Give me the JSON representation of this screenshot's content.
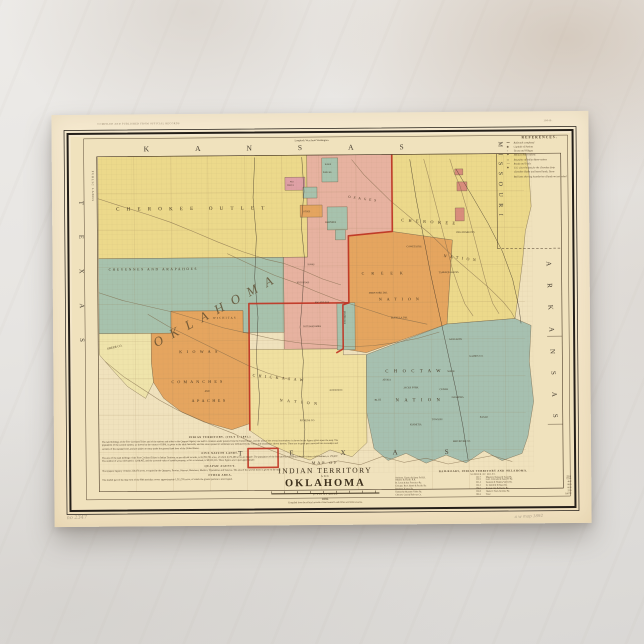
{
  "postcard": {
    "imprint_top_left": "COMPILED AND PUBLISHED FROM OFFICIAL RECORDS",
    "imprint_top_right": "18049.",
    "pencil_left": "no 2347",
    "pencil_right": "a w map 1892"
  },
  "map": {
    "palette": {
      "ivory": "#f0e2bd",
      "yellow": "#ecd98b",
      "paleYellow": "#efe4ab",
      "chickasaw": "#f0e0a0",
      "teal": "#a7c2ad",
      "choctawTeal": "#a6c0b0",
      "salmon": "#e7b2a0",
      "pink": "#dfa0a6",
      "orange": "#e5a55f",
      "red": "#c03524",
      "missouri": "#d98c7c"
    },
    "legend": {
      "title": "REFERENCES.",
      "entries": [
        {
          "s": "━━",
          "t": "Railroads completed"
        },
        {
          "s": "◉",
          "t": "Capitals of Nations"
        },
        {
          "s": "○",
          "t": "Towns and Villages"
        },
        {
          "s": "⚑",
          "t": "Military Reservations"
        },
        {
          "s": "▭",
          "t": "Boundary of Indian Reservations"
        },
        {
          "s": "╌╌",
          "t": "Roads and Trails"
        },
        {
          "s": "✚",
          "t": "U.S. Court houses for the Cherokee Strip"
        },
        {
          "s": "",
          "t": "Cherokee Outlet and leased lands, Texas"
        },
        {
          "s": "",
          "t": "Red lines showing boundaries of lands not yet ceded"
        }
      ]
    },
    "labels": [
      {
        "t": "KANSAS",
        "x": 92,
        "y": 37,
        "fs": 7.5,
        "ls": 46,
        "c": "state"
      },
      {
        "t": "MISSOURI",
        "x": 447,
        "y": 30,
        "fs": 6,
        "ls": 6.5,
        "r": 90,
        "c": "state"
      },
      {
        "t": "ARKANSAS",
        "x": 494,
        "y": 150,
        "fs": 7,
        "ls": 17,
        "r": 88,
        "c": "state"
      },
      {
        "t": "TEXAS",
        "x": 27,
        "y": 86,
        "fs": 6.5,
        "ls": 30,
        "r": 90,
        "c": "state"
      },
      {
        "t": "TEXAS",
        "x": 184,
        "y": 342,
        "fs": 7,
        "ls": 47,
        "c": "state"
      },
      {
        "t": "PUBLIC LANDS",
        "x": 40,
        "y": 56,
        "fs": 2.7,
        "ls": 1,
        "r": 90,
        "c": "small"
      },
      {
        "t": "Longitude West from Washington.",
        "x": 243,
        "y": 28,
        "fs": 2.5,
        "c": "small"
      },
      {
        "t": "CHEROKEE OUTLET",
        "x": 64,
        "y": 96,
        "fs": 5,
        "ls": 7.2
      },
      {
        "t": "CHEYENNES AND ARAPAHOES",
        "x": 56,
        "y": 156,
        "fs": 3.5,
        "ls": 1.7
      },
      {
        "t": "OKLAHOMA",
        "x": 103,
        "y": 233,
        "fs": 13,
        "ls": 9,
        "r": -28,
        "c": "big"
      },
      {
        "t": "KIOWAS",
        "x": 126,
        "y": 239,
        "fs": 4,
        "ls": 4.5
      },
      {
        "t": "COMANCHES",
        "x": 118,
        "y": 269,
        "fs": 4,
        "ls": 3.2
      },
      {
        "t": "AND",
        "x": 151,
        "y": 278,
        "fs": 2.4
      },
      {
        "t": "APACHES",
        "x": 138,
        "y": 288,
        "fs": 4,
        "ls": 2.6
      },
      {
        "t": "WICHITAS",
        "x": 160,
        "y": 205,
        "fs": 2.8,
        "ls": 1.3
      },
      {
        "t": "GREER CO.",
        "x": 54,
        "y": 235,
        "fs": 3,
        "r": -12
      },
      {
        "t": "CHICKASAW",
        "x": 199,
        "y": 263,
        "fs": 4,
        "ls": 3.4,
        "r": 6
      },
      {
        "t": "NATION",
        "x": 226,
        "y": 288,
        "fs": 4,
        "ls": 4.5,
        "r": 6
      },
      {
        "t": "CREEK",
        "x": 309,
        "y": 162,
        "fs": 4,
        "ls": 7
      },
      {
        "t": "NATION",
        "x": 326,
        "y": 188,
        "fs": 4,
        "ls": 5
      },
      {
        "t": "CHEROKEE",
        "x": 349,
        "y": 109,
        "fs": 4.2,
        "ls": 4.5,
        "r": 4
      },
      {
        "t": "NATION",
        "x": 391,
        "y": 145,
        "fs": 4,
        "ls": 3.5,
        "r": 8
      },
      {
        "t": "CHOCTAW",
        "x": 332,
        "y": 260,
        "fs": 4.5,
        "ls": 5.5
      },
      {
        "t": "NATION",
        "x": 342,
        "y": 289,
        "fs": 4.5,
        "ls": 5.5
      },
      {
        "t": "OSAGES",
        "x": 296,
        "y": 85,
        "fs": 3.4,
        "ls": 3,
        "r": 8
      },
      {
        "t": "PAWNEES",
        "x": 273,
        "y": 110,
        "fs": 2.4,
        "c": "small"
      },
      {
        "t": "NEZ",
        "x": 238,
        "y": 69,
        "fs": 1.9,
        "c": "small"
      },
      {
        "t": "PERCES",
        "x": 235,
        "y": 72.5,
        "fs": 1.9,
        "c": "small"
      },
      {
        "t": "OTOES",
        "x": 251,
        "y": 99,
        "fs": 2.2,
        "c": "small"
      },
      {
        "t": "KAWS",
        "x": 273,
        "y": 52,
        "fs": 2.2,
        "c": "small"
      },
      {
        "t": "PONCAS",
        "x": 271,
        "y": 60,
        "fs": 2.2,
        "c": "small"
      },
      {
        "t": "SEMINOLES",
        "x": 291,
        "y": 198,
        "fs": 2.4,
        "r": 90,
        "c": "small"
      },
      {
        "t": "IOWAS",
        "x": 255,
        "y": 152,
        "fs": 2.2,
        "c": "small"
      },
      {
        "t": "KICKAPOOS",
        "x": 244,
        "y": 170,
        "fs": 2.2,
        "c": "small"
      },
      {
        "t": "POTTAWATOMIES",
        "x": 250,
        "y": 214,
        "fs": 2.2,
        "c": "small"
      },
      {
        "t": "SAC AND FOX",
        "x": 262,
        "y": 190,
        "fs": 2.2,
        "c": "small"
      },
      {
        "t": "SANS BOIS",
        "x": 396,
        "y": 228,
        "fs": 2.5,
        "c": "small"
      },
      {
        "t": "GAINES CO.",
        "x": 416,
        "y": 245,
        "fs": 2.5,
        "c": "small"
      },
      {
        "t": "JACKS FORK",
        "x": 350,
        "y": 276,
        "fs": 2.5,
        "c": "small"
      },
      {
        "t": "CEDAR",
        "x": 386,
        "y": 278,
        "fs": 2.5,
        "c": "small"
      },
      {
        "t": "NASHOBA",
        "x": 398,
        "y": 286,
        "fs": 2.5,
        "c": "small"
      },
      {
        "t": "WADE",
        "x": 394,
        "y": 260,
        "fs": 2.5,
        "c": "small"
      },
      {
        "t": "TOWSON",
        "x": 378,
        "y": 308,
        "fs": 2.5,
        "c": "small"
      },
      {
        "t": "EAGLE",
        "x": 426,
        "y": 306,
        "fs": 2.5,
        "c": "small"
      },
      {
        "t": "RED RIVER CO.",
        "x": 399,
        "y": 330,
        "fs": 2.5,
        "c": "small"
      },
      {
        "t": "KIAMITIA",
        "x": 356,
        "y": 313,
        "fs": 2.5,
        "c": "small"
      },
      {
        "t": "ATOKA",
        "x": 329,
        "y": 268,
        "fs": 2.5,
        "c": "small"
      },
      {
        "t": "BLUE",
        "x": 321,
        "y": 288,
        "fs": 2.5,
        "c": "small"
      },
      {
        "t": "COWETA DIS.",
        "x": 354,
        "y": 135,
        "fs": 2.5,
        "c": "small"
      },
      {
        "t": "DEEP FORK DIS.",
        "x": 316,
        "y": 181,
        "fs": 2.5,
        "c": "small"
      },
      {
        "t": "EUFAULA DIS.",
        "x": 338,
        "y": 206,
        "fs": 2.5,
        "c": "small"
      },
      {
        "t": "TAHLEQUAH DIS.",
        "x": 386,
        "y": 161,
        "fs": 2.5,
        "c": "small"
      },
      {
        "t": "DELAWARE DIS.",
        "x": 404,
        "y": 121,
        "fs": 2.5,
        "c": "small"
      },
      {
        "t": "PICKENS CO.",
        "x": 246,
        "y": 308,
        "fs": 2.5,
        "c": "small"
      },
      {
        "t": "PONTOTOC",
        "x": 276,
        "y": 278,
        "fs": 2.5,
        "c": "small"
      }
    ],
    "title_block": {
      "map_of": "MAP OF",
      "line1": "INDIAN TERRITORY",
      "and": "AND",
      "line2": "OKLAHOMA",
      "scale_label": "SCALE OF MILES",
      "year": "1892.",
      "compiled": "Compiled from the official records of the General Land Office and other sources."
    },
    "notes_blocks": [
      {
        "h": "INDIAN TERRITORY.  (JULY 1, 1891.)",
        "lines": [
          "The land holdings of the Five Civilized Tribes and of the nations and tribes in the Quapaw Agency are held in common under patents from the United States, and the area of the several reservations is shown by the figures given upon the map.  The population of the several nations, as shown by the census of 1890, is given in the table herewith, and the areas opened to settlement are indicated by the colors and boundaries shown hereon.  These are in great part surveyed into townships and sections of the standard size, and are subject to entry under the general land laws of the United States."
        ]
      },
      {
        "h": "FIVE NATION LANDS.",
        "lines": [
          "The area of the land holdings of the Five Civilized Tribes in Indian Territory, as per official records, is 19,785,781 acres, of which 6,574,486 acres are tillable.  The population of the five nations, including adopted citizens and freedmen, is 178,097.  The number of acres cultivated is 1,198,465, and the assessed value of taxable property, so far as returned, is $8,922,513.  These figures are in part approximate."
        ]
      },
      {
        "h": "QUAPAW AGENCY.",
        "lines": [
          "The Quapaw Agency contains 220,076 acres, occupied by the Quapaws, Peorias, Ottawas, Shawnees, Modocs, Wyandottes and Senecas.  The area of the several tracts is given on the map."
        ]
      },
      {
        "h": "OTHER AREA.",
        "lines": [
          "The shaded part of the map west of the 98th meridian covers approximately 1,511,576 acres, of which the greater portion is unoccupied."
        ]
      }
    ],
    "rail_table": {
      "heading": "RAILROADS, INDIAN TERRITORY AND OKLAHOMA.",
      "subheading": "NUMBER OF MILES.",
      "left_rows": [
        {
          "name": "Atchison, Topeka & Santa Fe R.R.",
          "miles": "121.7"
        },
        {
          "name": "Atlantic & Pacific R.R.",
          "miles": "112.5"
        },
        {
          "name": "St. Louis & San Francisco Ry.",
          "miles": "231.4"
        },
        {
          "name": "Chicago, Rock Island & Pacific Ry.",
          "miles": "134.2"
        },
        {
          "name": "Southern Kansas Ry.",
          "miles": "154.0"
        },
        {
          "name": "Kansas & Arkansas Valley Ry.",
          "miles": "120.8"
        },
        {
          "name": "Choctaw Coal & Railway Co.",
          "miles": "104.6"
        }
      ],
      "right_rows": [
        {
          "name": "Missouri, Kansas & Texas Ry.",
          "miles": "255.1"
        },
        {
          "name": "Gulf, Colorado & Santa Fe Ry.",
          "miles": "153.3"
        },
        {
          "name": "Denison & Washita Valley Ry.",
          "miles": "40.2"
        },
        {
          "name": "Ft. Smith & El Reno Ry.",
          "miles": "88.0"
        },
        {
          "name": "Kansas City & Pacific Ry.",
          "miles": "66.4"
        },
        {
          "name": "Hunter's Track & Other Ry.",
          "miles": "25.0"
        },
        {
          "name": "Total",
          "miles": "1,607.2"
        }
      ]
    }
  }
}
